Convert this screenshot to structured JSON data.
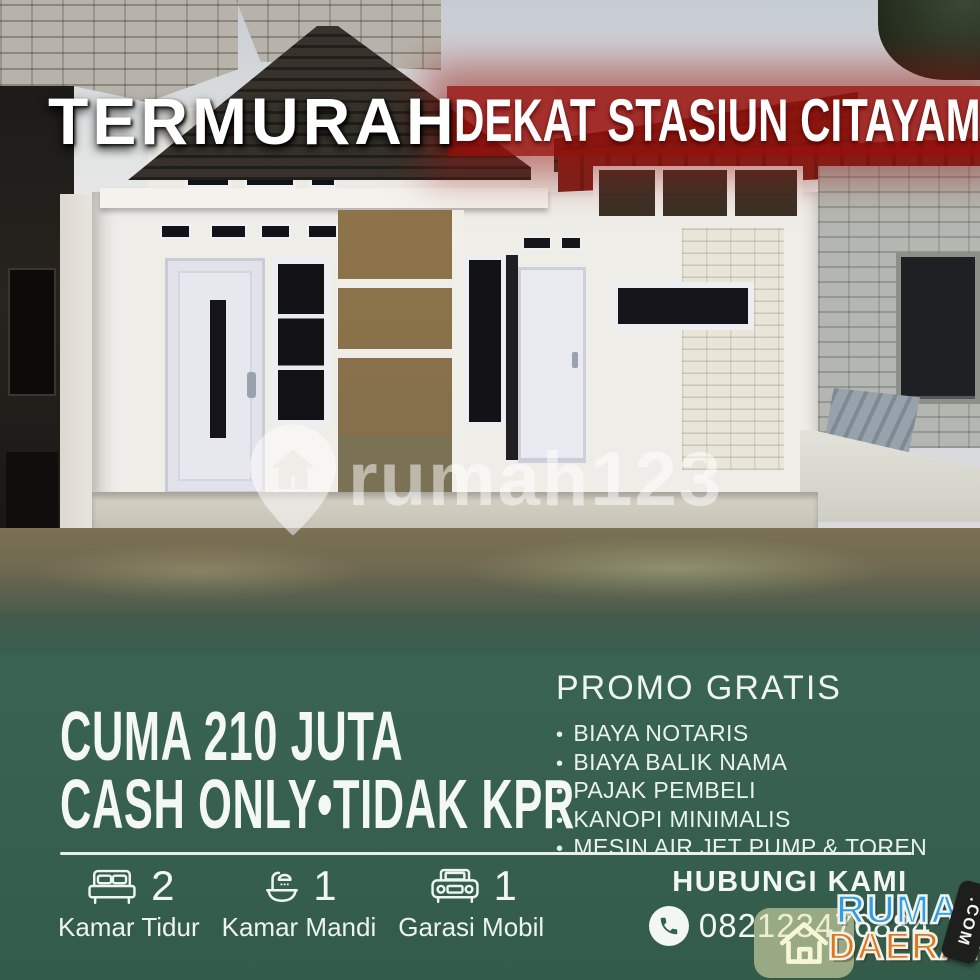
{
  "headline": {
    "left": "TERMURAH",
    "right": "DEKAT STASIUN CITAYAM"
  },
  "watermark": {
    "brand": "rumah123"
  },
  "panel": {
    "price_line1": "CUMA 210 JUTA",
    "price_line2": "CASH ONLY•TIDAK KPR",
    "promo_title": "PROMO GRATIS",
    "promo_bullet": "•",
    "promo_items": [
      "BIAYA NOTARIS",
      "BIAYA BALIK NAMA",
      "PAJAK PEMBELI",
      "KANOPI MINIMALIS",
      "MESIN AIR JET PUMP & TOREN"
    ],
    "features": [
      {
        "count": "2",
        "label": "Kamar Tidur"
      },
      {
        "count": "1",
        "label": "Kamar Mandi"
      },
      {
        "count": "1",
        "label": "Garasi Mobil"
      }
    ],
    "contact_title": "HUBUNGI KAMI",
    "phone": "082123476884"
  },
  "agency": {
    "name_top": "RUMAH",
    "name_bottom": "DAERAH",
    "tld": ".COM"
  },
  "colors": {
    "panel_green": "#38614f",
    "banner_red": "#9b100c",
    "agency_blue": "#2d9fe8",
    "agency_orange": "#e0761c"
  }
}
